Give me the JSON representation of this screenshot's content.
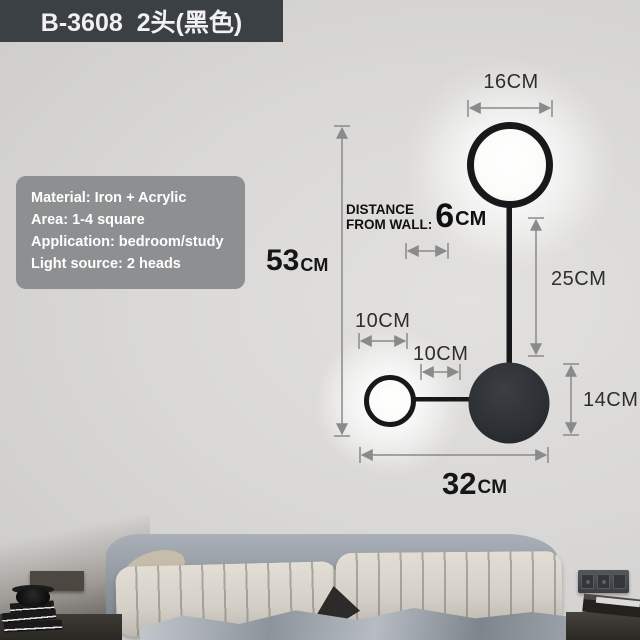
{
  "header": {
    "product_code": "B-3608  2头(黑色)"
  },
  "specs": {
    "material": "Material: Iron + Acrylic",
    "area": "Area: 1-4 square",
    "application": "Application: bedroom/study",
    "light_source": "Light source: 2 heads"
  },
  "dimensions": {
    "top_width": "16CM",
    "height_value": "53",
    "height_unit": "CM",
    "wall_label_1": "DISTANCE",
    "wall_label_2": "FROM WALL:",
    "wall_value": "6",
    "wall_unit": "CM",
    "drop": "25CM",
    "small_ring": "10CM",
    "arm": "10CM",
    "disc": "14CM",
    "width_value": "32",
    "width_unit": "CM"
  },
  "colors": {
    "label_bg": "#3b4045",
    "specs_bg": "#8b8d90",
    "lamp_black": "#17181a",
    "disc_fill": "#2e3134",
    "dim_line": "#8a8a8a",
    "wall": "#d9d8d6"
  }
}
